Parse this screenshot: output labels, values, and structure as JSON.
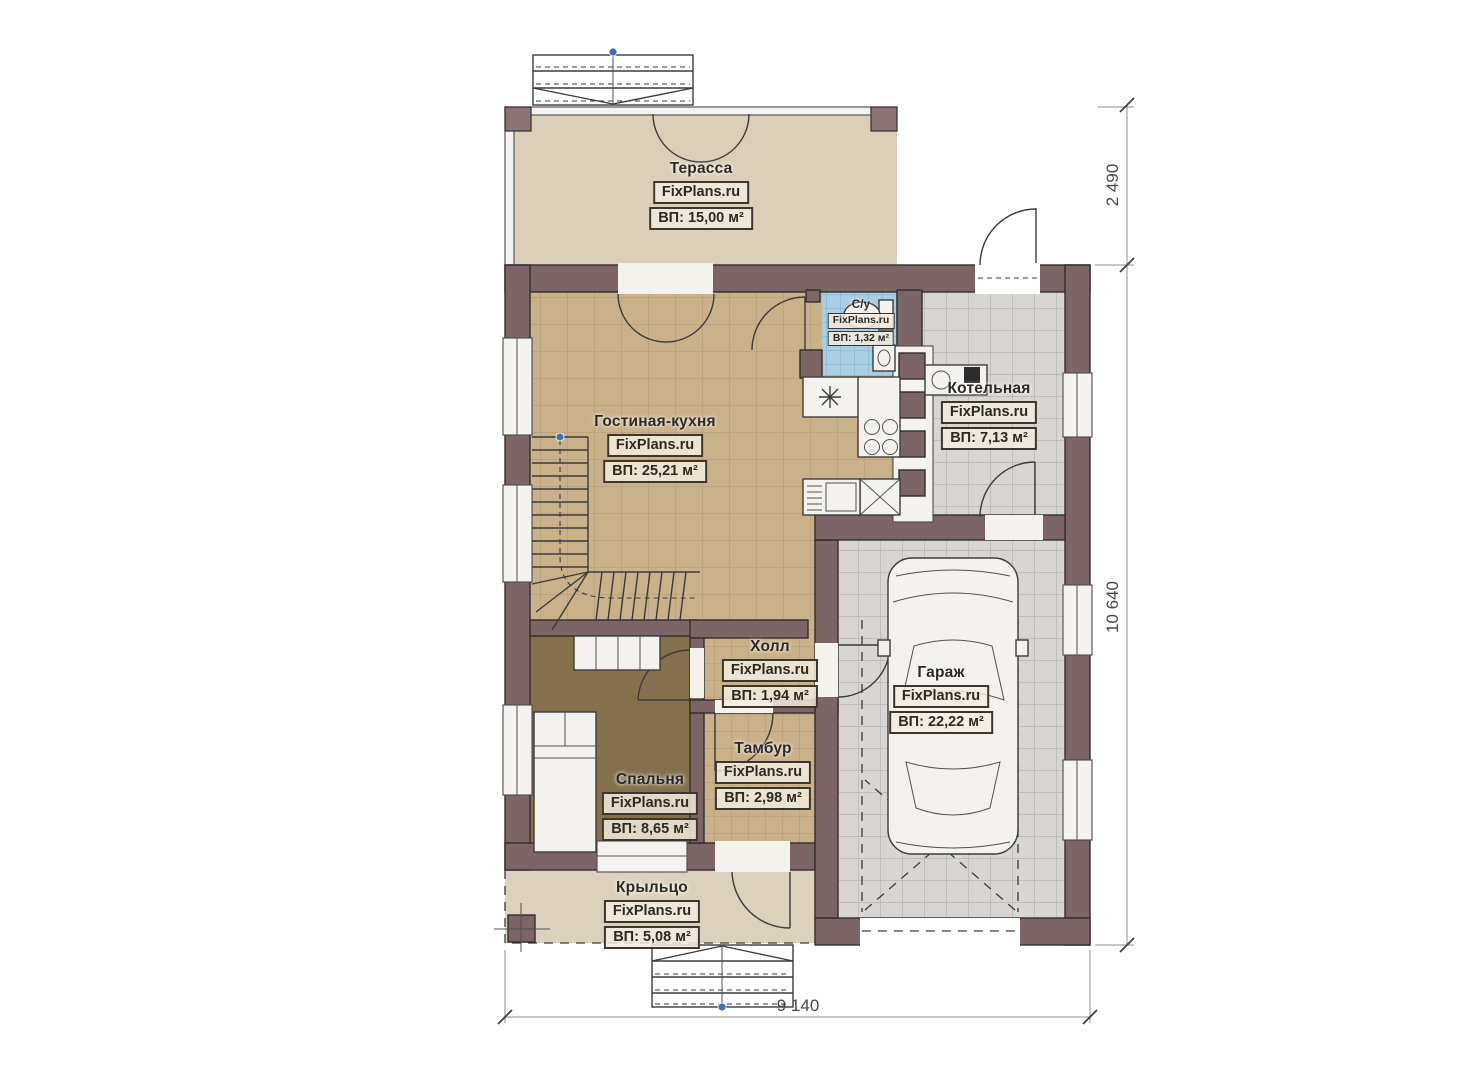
{
  "brand": "FixPlans.ru",
  "rooms": [
    {
      "id": "terrace",
      "name": "Терасса",
      "area": "ВП: 15,00 м²"
    },
    {
      "id": "bathroom",
      "name": "С/у",
      "area": "ВП: 1,32 м²"
    },
    {
      "id": "boiler-room",
      "name": "Котельная",
      "area": "ВП: 7,13 м²"
    },
    {
      "id": "living-kitchen",
      "name": "Гостиная-кухня",
      "area": "ВП: 25,21 м²"
    },
    {
      "id": "hall",
      "name": "Холл",
      "area": "ВП: 1,94 м²"
    },
    {
      "id": "garage",
      "name": "Гараж",
      "area": "ВП: 22,22 м²"
    },
    {
      "id": "vestibule",
      "name": "Тамбур",
      "area": "ВП: 2,98 м²"
    },
    {
      "id": "bedroom",
      "name": "Спальня",
      "area": "ВП: 8,65 м²"
    },
    {
      "id": "porch",
      "name": "Крыльцо",
      "area": "ВП: 5,08 м²"
    }
  ],
  "dimensions": {
    "right_upper": "2 490",
    "right_lower": "10 640",
    "bottom": "9 140"
  },
  "colors": {
    "wall": "#7c6567",
    "terrace_floor": "#dbcfb9",
    "tile_tan": "#c9b189",
    "tile_gray": "#d7d6d3",
    "tile_blue": "#a9cfe5",
    "bedroom_floor": "#85704e",
    "porch_floor": "#dcd1bd"
  }
}
